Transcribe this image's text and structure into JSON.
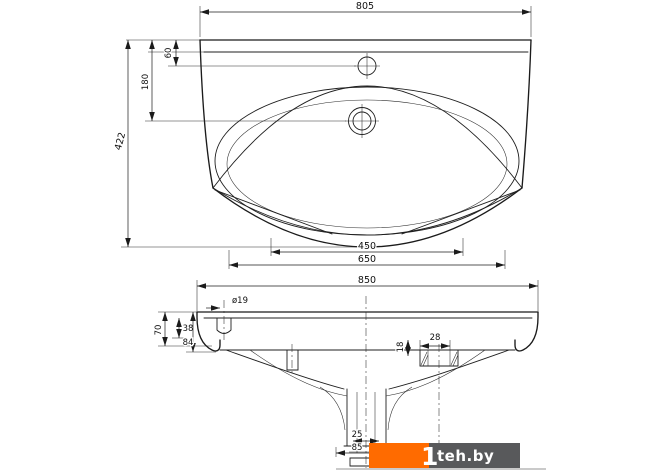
{
  "plan_view": {
    "dim_top_width": "805",
    "dim_faucet_offset": "60",
    "dim_drain_offset": "180",
    "dim_depth": "422",
    "dim_inner_width": "450",
    "dim_bowl_width": "650",
    "dim_overall_width": "850"
  },
  "front_view": {
    "dim_hole_diameter": "ø19",
    "dim_side_height": "70",
    "dim_side_upper": "38",
    "dim_side_lower": "84",
    "dim_bracket_offset": "18",
    "dim_bracket_width": "28",
    "dim_drain_neck": "25",
    "dim_drain_flange": "85"
  },
  "watermark": {
    "prefix": "1",
    "site": "teh.by",
    "orange_color": "#ff6b00",
    "gray_color": "#58595b"
  }
}
